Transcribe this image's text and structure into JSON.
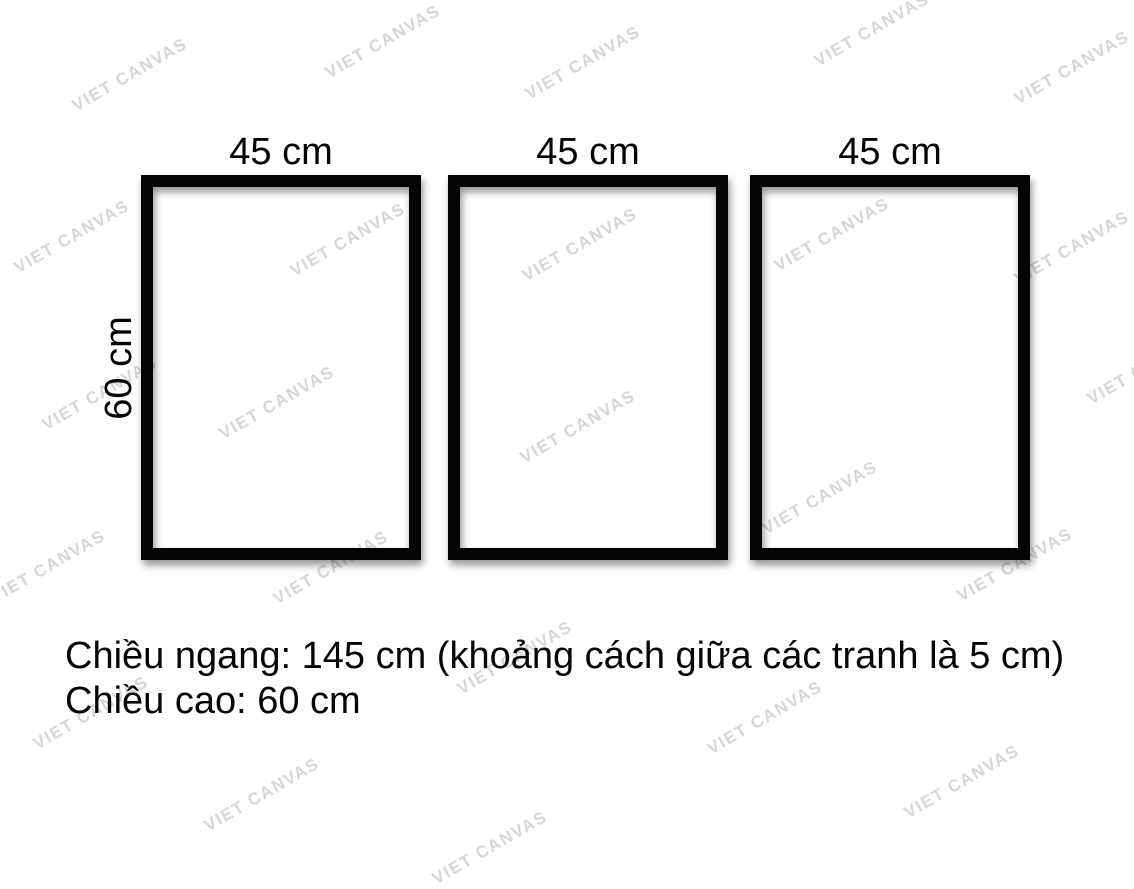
{
  "diagram": {
    "frames": [
      {
        "width_label": "45 cm"
      },
      {
        "width_label": "45 cm"
      },
      {
        "width_label": "45 cm"
      }
    ],
    "height_label": "60 cm",
    "frame_border_color": "#050505"
  },
  "caption": {
    "line1": "Chiều ngang: 145 cm (khoảng cách giữa các tranh là 5 cm)",
    "line2": "Chiều cao: 60 cm"
  },
  "watermark": {
    "text": "VIET CANVAS",
    "color": "#d6d6d6",
    "positions": [
      {
        "x": 130,
        "y": 75
      },
      {
        "x": 383,
        "y": 42
      },
      {
        "x": 583,
        "y": 63
      },
      {
        "x": 872,
        "y": 30
      },
      {
        "x": 1072,
        "y": 68
      },
      {
        "x": 72,
        "y": 237
      },
      {
        "x": 348,
        "y": 240
      },
      {
        "x": 580,
        "y": 245
      },
      {
        "x": 832,
        "y": 235
      },
      {
        "x": 1072,
        "y": 248
      },
      {
        "x": 100,
        "y": 394
      },
      {
        "x": 277,
        "y": 403
      },
      {
        "x": 578,
        "y": 427
      },
      {
        "x": 1145,
        "y": 368
      },
      {
        "x": 48,
        "y": 567
      },
      {
        "x": 331,
        "y": 568
      },
      {
        "x": 820,
        "y": 498
      },
      {
        "x": 1015,
        "y": 565
      },
      {
        "x": 515,
        "y": 658
      },
      {
        "x": 91,
        "y": 713
      },
      {
        "x": 765,
        "y": 718
      },
      {
        "x": 262,
        "y": 795
      },
      {
        "x": 962,
        "y": 782
      },
      {
        "x": 490,
        "y": 848
      }
    ]
  }
}
